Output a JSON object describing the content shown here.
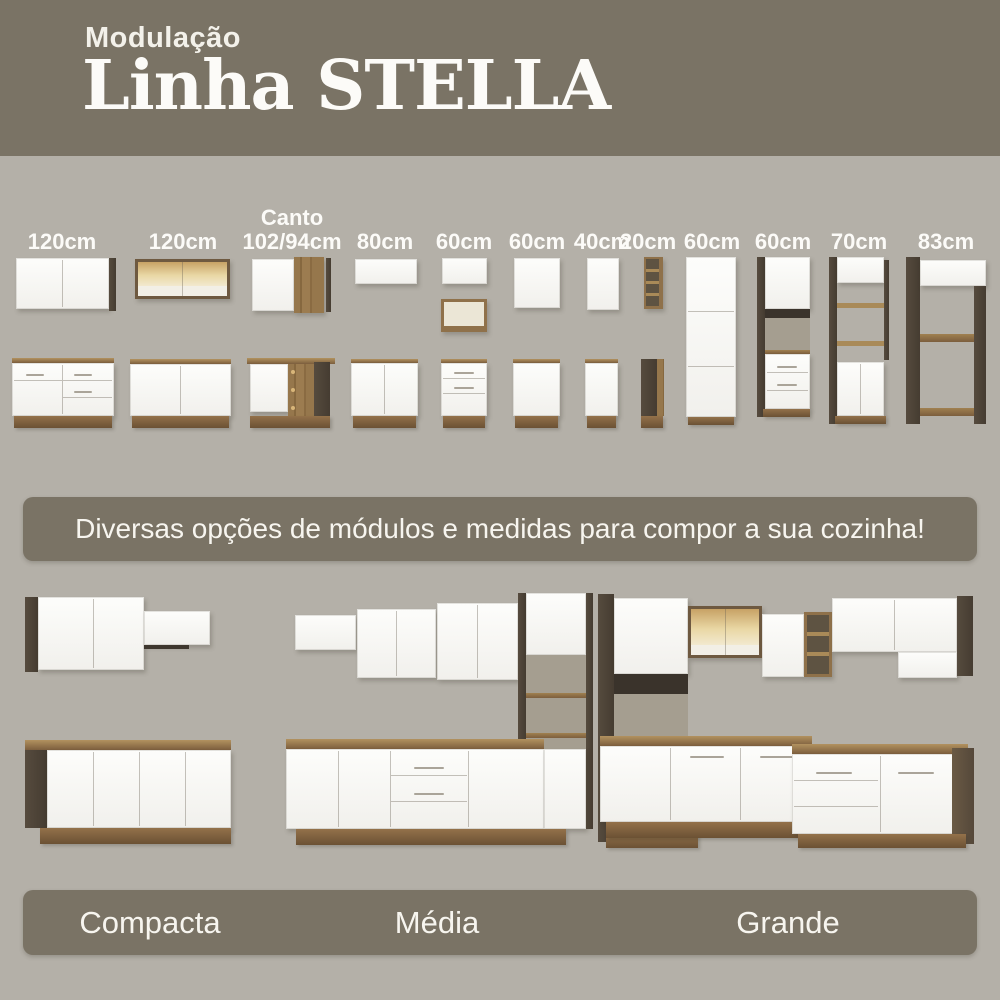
{
  "colors": {
    "olive": "#7a7365",
    "background_gray": "#b4b0a8",
    "cabinet_white": "#f8f7f4",
    "wood": "#8a6a45",
    "wood_dark": "#4b4237",
    "glass_amber": "#e3cf9d"
  },
  "header": {
    "kicker": "Modulação",
    "title": "Linha STELLA"
  },
  "modules": {
    "items": [
      {
        "name": "wall-cabinet-and-base-120",
        "label": "120cm"
      },
      {
        "name": "glass-wall-cabinet-and-base-120",
        "label": "120cm"
      },
      {
        "name": "corner-wall-and-base",
        "label_top": "Canto",
        "label": "102/94cm"
      },
      {
        "name": "wall-cabinet-and-base-80",
        "label": "80cm"
      },
      {
        "name": "wall-niche-and-drawer-base-60",
        "label": "60cm"
      },
      {
        "name": "wall-cabinet-and-base-60",
        "label": "60cm"
      },
      {
        "name": "wall-cabinet-and-base-40",
        "label": "40cm"
      },
      {
        "name": "open-shelf-and-base-20",
        "label": "20cm"
      },
      {
        "name": "tall-pantry-60",
        "label": "60cm"
      },
      {
        "name": "tall-oven-tower-60",
        "label": "60cm"
      },
      {
        "name": "tall-shelved-cabinet-70",
        "label": "70cm"
      },
      {
        "name": "tall-open-cabinet-83",
        "label": "83cm"
      }
    ]
  },
  "banner": {
    "text": "Diversas opções de módulos e medidas para compor a sua cozinha!"
  },
  "kitchens": {
    "sizes": [
      {
        "label": "Compacta"
      },
      {
        "label": "Média"
      },
      {
        "label": "Grande"
      }
    ]
  }
}
